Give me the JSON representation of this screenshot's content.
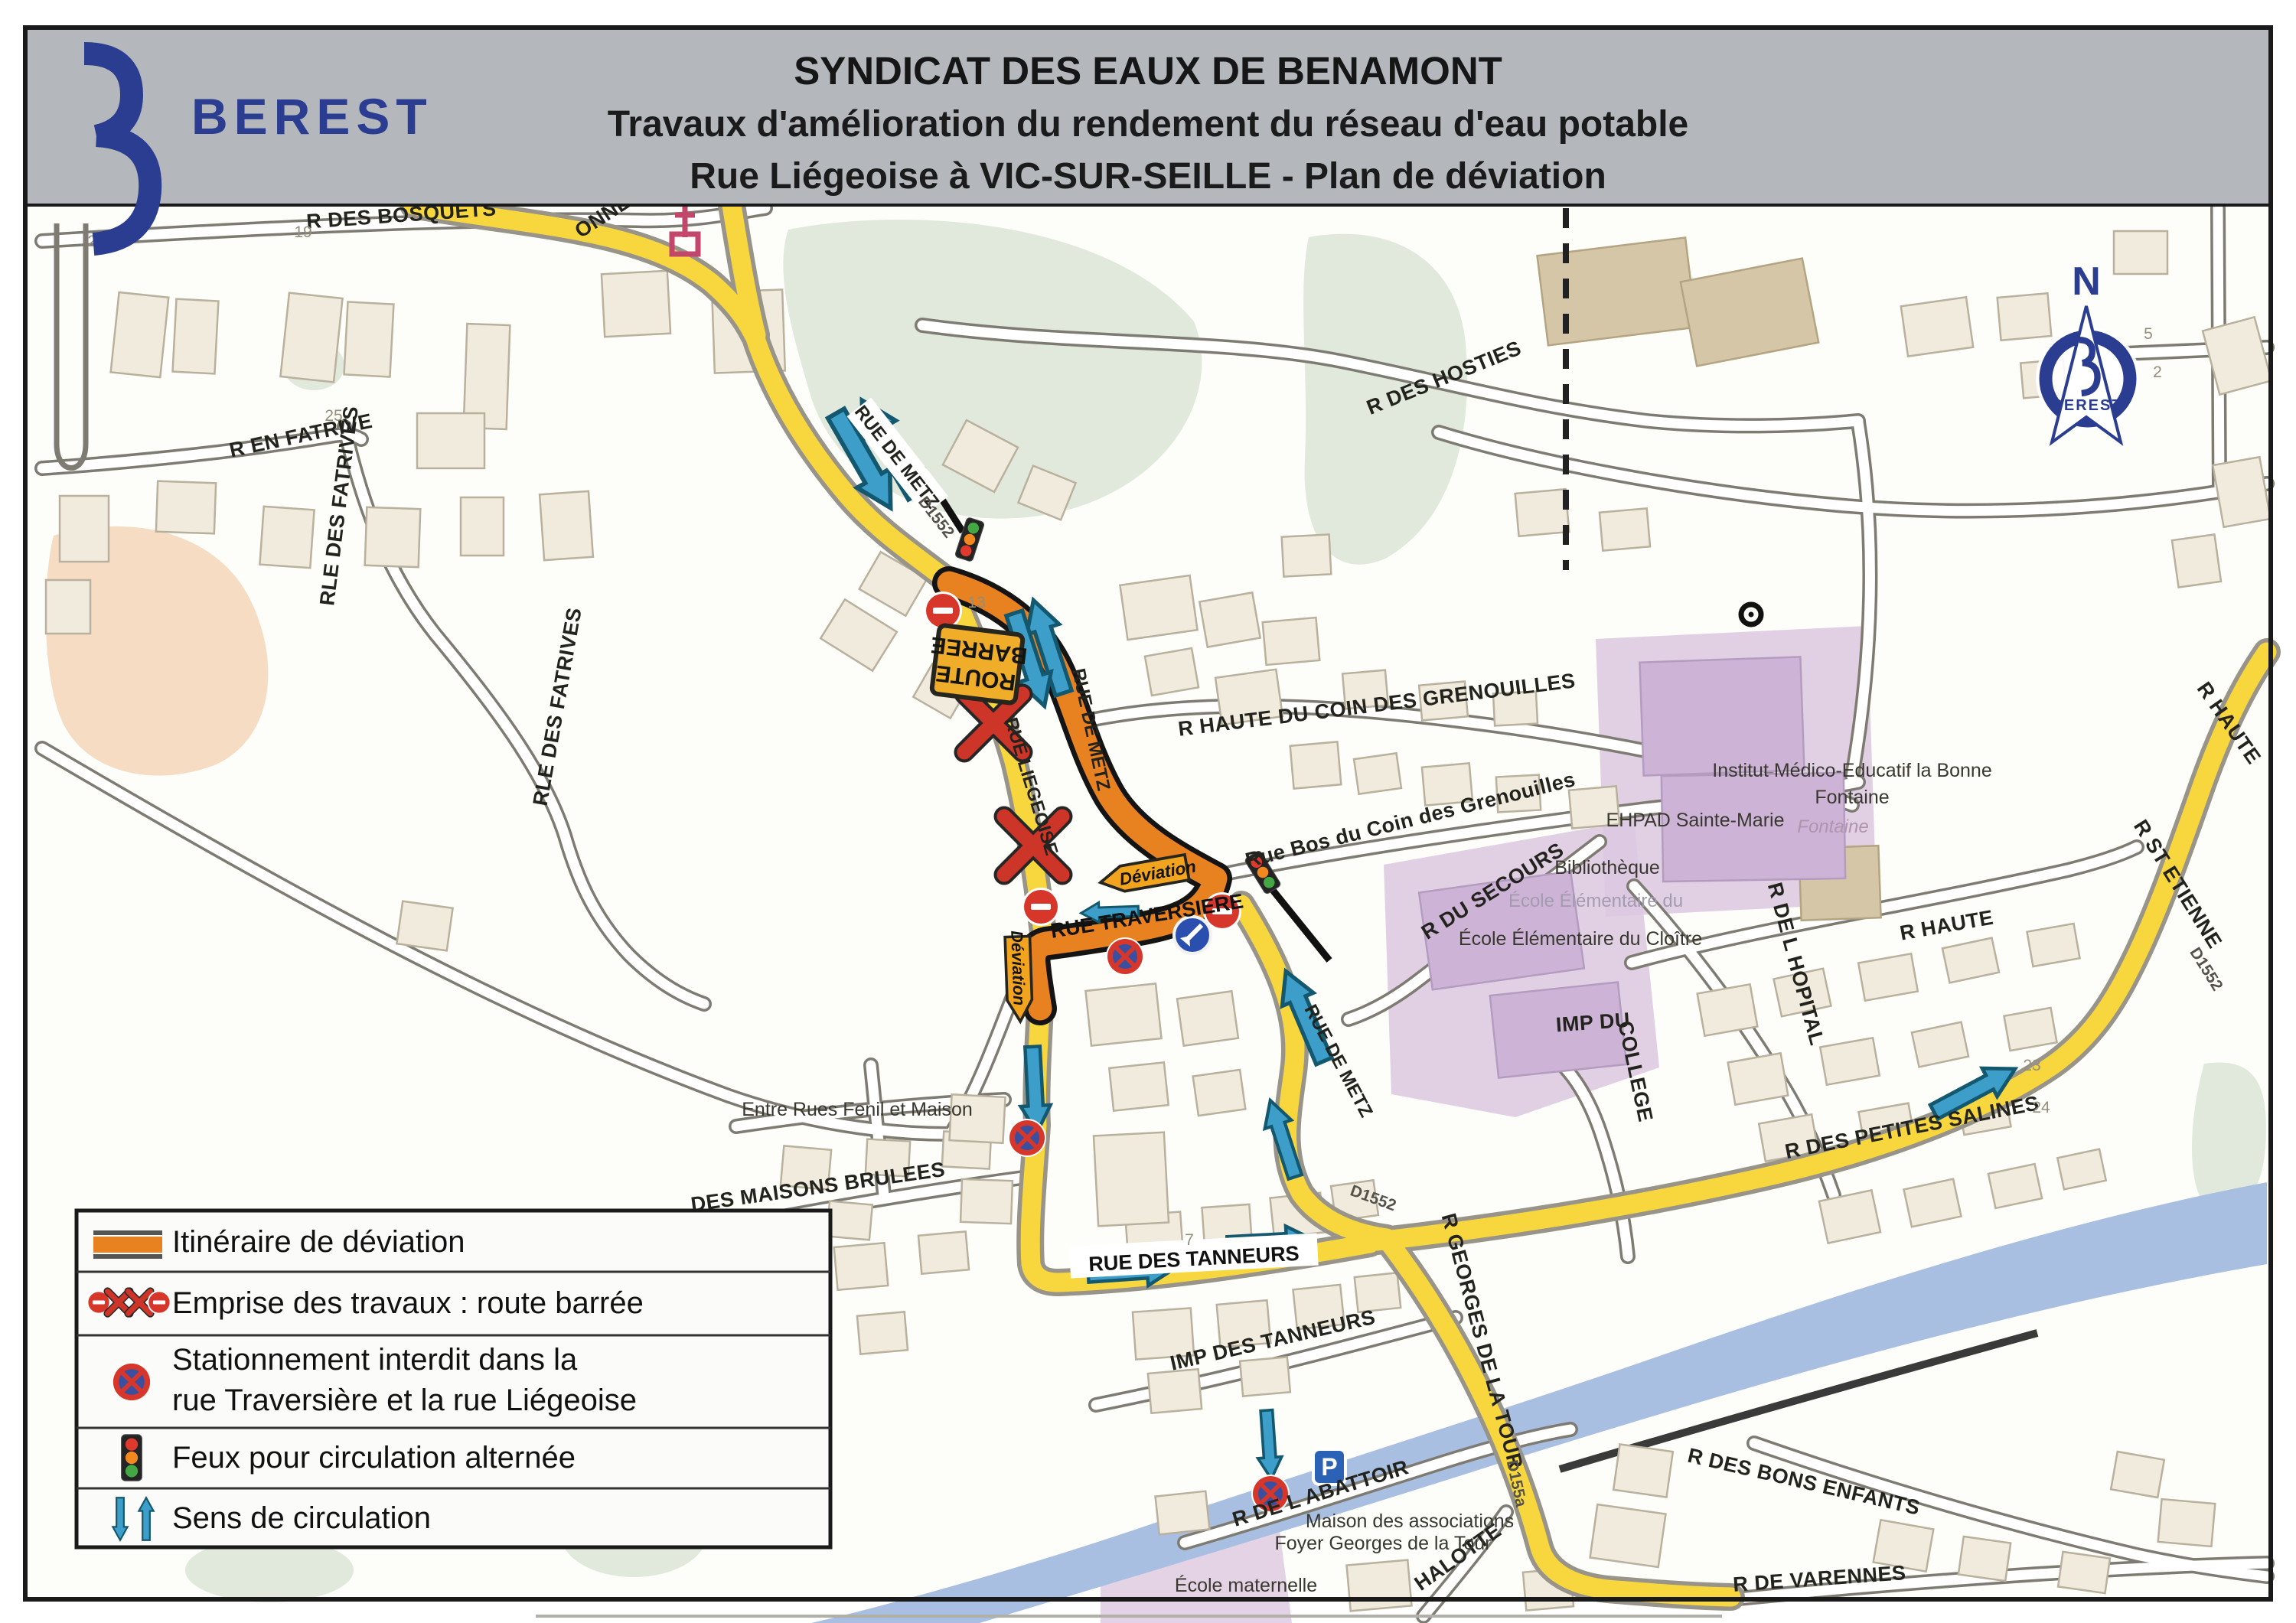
{
  "header": {
    "brand": "BEREST",
    "title_line1": "SYNDICAT DES EAUX DE BENAMONT",
    "title_line2": "Travaux d'amélioration du rendement du réseau d'eau potable",
    "title_line3": "Rue Liégeoise à VIC-SUR-SEILLE - Plan de déviation"
  },
  "compass": {
    "north": "N",
    "brand": "BEREST"
  },
  "legend": {
    "row1": "Itinéraire de déviation",
    "row2": "Emprise des travaux : route barrée",
    "row3_line1": "Stationnement interdit dans la",
    "row3_line2": "rue Traversière et la rue Liégeoise",
    "row4": "Feux pour circulation alternée",
    "row5": "Sens de circulation"
  },
  "signs": {
    "route_barree_line1": "ROUTE",
    "route_barree_line2": "BARREE",
    "deviation_left": "Déviation",
    "deviation_down": "Déviation",
    "parking": "P"
  },
  "icons": {
    "legend_row1": "deviation-route-line",
    "legend_row2": "no-entry-sign, road-closed-cross",
    "legend_row3": "no-parking-sign",
    "legend_row4": "traffic-light",
    "legend_row5": "two-way-arrows",
    "map": "church-icon, parking-icon, keep-left-sign, roundabout-dot, north-compass"
  },
  "map_labels": [
    {
      "text": "R DES BOSQUETS"
    },
    {
      "text": "ONNES"
    },
    {
      "text": "R EN FATRIVE"
    },
    {
      "text": "RLE DES FATRIVES"
    },
    {
      "text": "RLE DES FATRIVES"
    },
    {
      "text": "R DES HOSTIES"
    },
    {
      "text": "RUE DE METZ"
    },
    {
      "text": "D1552"
    },
    {
      "text": "RUE LIEGEOISE"
    },
    {
      "text": "RUE DE METZ"
    },
    {
      "text": "RUE TRAVERSIERE"
    },
    {
      "text": "RUE DE METZ"
    },
    {
      "text": "R HAUTE DU COIN DES GRENOUILLES"
    },
    {
      "text": "Rue Bos du Coin des Grenouilles"
    },
    {
      "text": "R DU SECOURS"
    },
    {
      "text": "Bibliothèque"
    },
    {
      "text": "École Élémentaire du"
    },
    {
      "text": "École Élémentaire du Cloître"
    },
    {
      "text": "EHPAD Sainte-Marie"
    },
    {
      "text": "Institut Médico-Educatif la Bonne"
    },
    {
      "text": "Fontaine"
    },
    {
      "text": "Fontaine"
    },
    {
      "text": "R DE L HOPITAL"
    },
    {
      "text": "R HAUTE"
    },
    {
      "text": "IMP DU"
    },
    {
      "text": "COLLEGE"
    },
    {
      "text": "R HAUTE"
    },
    {
      "text": "R ST ETIENNE"
    },
    {
      "text": "D1552"
    },
    {
      "text": "R DES PETITES SALINES"
    },
    {
      "text": "D1552"
    },
    {
      "text": "RUE DES TANNEURS"
    },
    {
      "text": "IMP DES TANNEURS"
    },
    {
      "text": "R GEORGES DE LA TOUR"
    },
    {
      "text": "D155a"
    },
    {
      "text": "R DES BONS ENFANTS"
    },
    {
      "text": "R DE VARENNES"
    },
    {
      "text": "HALOTTE"
    },
    {
      "text": "R DE L ABATTOIR"
    },
    {
      "text": "Maison des associations"
    },
    {
      "text": "Foyer Georges de la Tour"
    },
    {
      "text": "École maternelle"
    },
    {
      "text": "Entre Rues Fenil et Maison"
    },
    {
      "text": "DES MAISONS BRULEES"
    }
  ],
  "nums": [
    "25",
    "19",
    "25",
    "13",
    "23",
    "24",
    "7",
    "5",
    "2"
  ],
  "colors": {
    "deviation_orange": "#E8811F",
    "road_yellow": "#F8D73E",
    "arrow_blue": "#3D9FC9",
    "sign_red": "#D7372B",
    "brand_navy": "#2B3D91",
    "school_purple": "#DCC8E0",
    "water_blue": "#A9BFE2",
    "vegetation_green": "#E0E9DC",
    "header_grey": "#B4B7BC"
  }
}
